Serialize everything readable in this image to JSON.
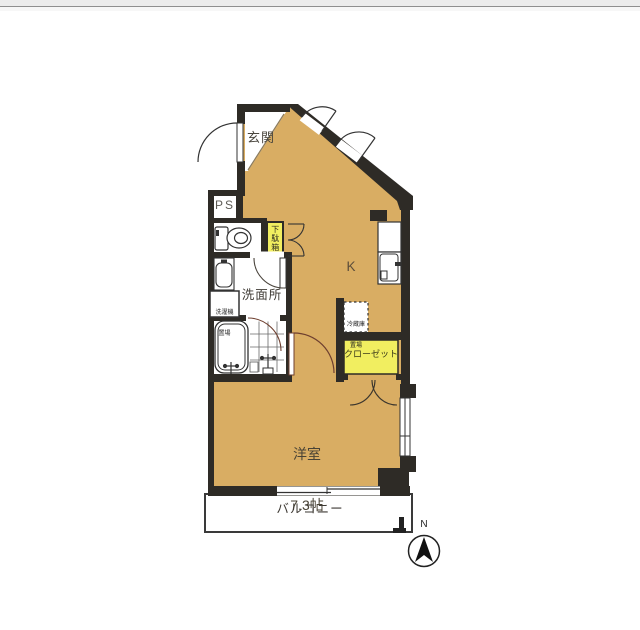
{
  "floor_plan": {
    "rooms": {
      "entrance_label": "玄関",
      "pipe_space_label": "PS",
      "shoe_cabinet_label": "下駄箱",
      "washroom_label": "洗面所",
      "laundry_space_label_line1": "洗濯機",
      "laundry_space_label_line2": "置場",
      "kitchen_label": "K",
      "refrigerator_space_label_line1": "冷蔵庫",
      "refrigerator_space_label_line2": "置場",
      "closet_label": "クローゼット",
      "western_room_label_line1": "洋室",
      "western_room_label_line2": "7.3帖",
      "balcony_label": "バルコニー"
    },
    "compass": {
      "north_label": "N"
    },
    "colors": {
      "floor": "#d9ad63",
      "storage": "#f1ee60",
      "wall": "#2e2b26",
      "door_arc": "#6e3f2f"
    }
  }
}
